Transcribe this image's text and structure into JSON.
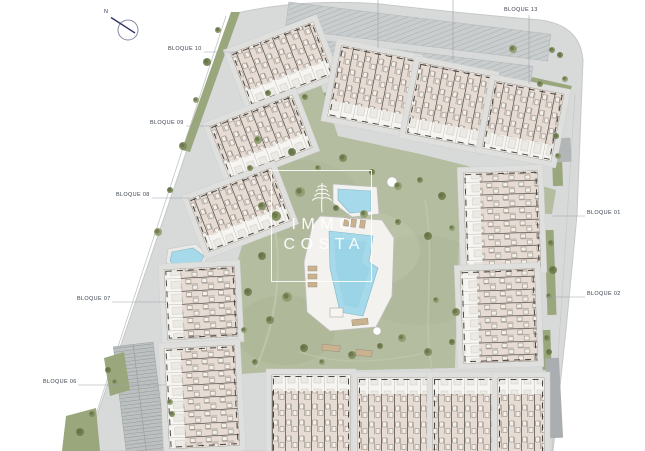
{
  "title": "Residential complex site plan",
  "compass": {
    "label": "N"
  },
  "logo": {
    "line1": "IMMO",
    "line2": "COSTA",
    "icon": "palm-tree-icon"
  },
  "labels": {
    "bloque10": "BLOQUE 10",
    "bloque09": "BLOQUE 09",
    "bloque08": "BLOQUE 08",
    "bloque07": "BLOQUE 07",
    "bloque06": "BLOQUE 06",
    "bloque13": "BLOQUE 13",
    "bloque01": "BLOQUE 01",
    "bloque02": "BLOQUE 02"
  },
  "palette": {
    "background": "#ffffff",
    "pavement": "#d8dad9",
    "parking": "#c9cdce",
    "lawn": "#b5bda0",
    "hedge": "#9aa77d",
    "tree": "#6e7c4d",
    "building_roof": "#e6dcd4",
    "building_terrace": "#f6f5f2",
    "building_wall": "#2f2c28",
    "pool_water": "#a6d9e9",
    "pool_deck": "#f3f2ef",
    "leader_line": "#9ba1ac",
    "label_text": "#3c4250",
    "logo_white": "#ffffff"
  }
}
